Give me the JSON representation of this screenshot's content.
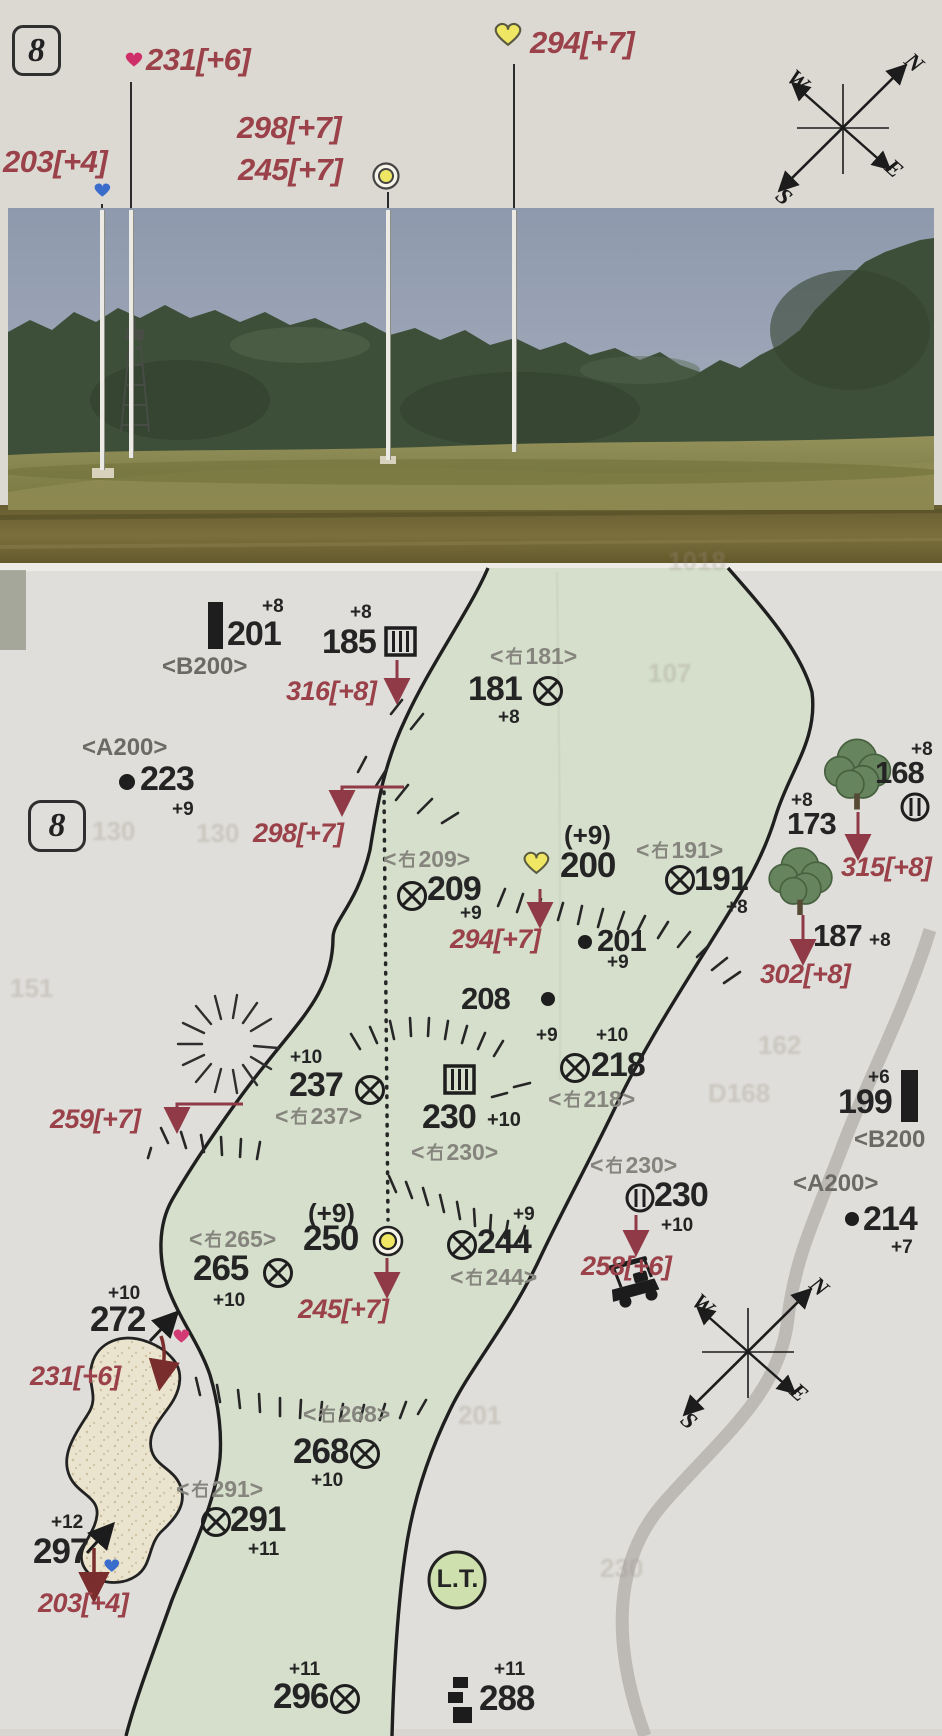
{
  "hole": "8",
  "compass": {
    "n": "N",
    "w": "W",
    "e": "E",
    "s": "S"
  },
  "sym": {
    "lt": "<"
  },
  "top": {
    "f231": "231[+6]",
    "f294": "294[+7]",
    "f298": "298[+7]",
    "f245": "245[+7]",
    "f203": "203[+4]"
  },
  "map": {
    "m201": {
      "v": "201",
      "sup": "+8",
      "ref": "<B200>"
    },
    "m185": {
      "v": "185",
      "sup": "+8"
    },
    "a316": "316[+8]",
    "m181": {
      "v": "181",
      "sup": "+8",
      "ref": "181>"
    },
    "m223": {
      "v": "223",
      "sup": "+9",
      "ref": "<A200>"
    },
    "a298": "298[+7]",
    "m209": {
      "v": "209",
      "sup": "+9",
      "ref": "209>"
    },
    "m200": {
      "v": "200",
      "pre": "(+9)"
    },
    "a294": "294[+7]",
    "m191": {
      "v": "191",
      "sup": "+8",
      "ref": "191>"
    },
    "m201b": {
      "v": "201",
      "sup": "+9"
    },
    "m208": {
      "v": "208",
      "sup": "+9"
    },
    "m218": {
      "v": "218",
      "sup": "+10",
      "ref": "218>"
    },
    "m237": {
      "v": "237",
      "sup": "+10",
      "ref": "237>"
    },
    "m230": {
      "v": "230",
      "sup": "+10",
      "ref": "230>"
    },
    "a259": "259[+7]",
    "m250": {
      "v": "250",
      "pre": "(+9)"
    },
    "a245": "245[+7]",
    "m265": {
      "v": "265",
      "sup": "+10",
      "ref": "265>"
    },
    "m244": {
      "v": "244",
      "sup": "+9",
      "ref": "244>"
    },
    "m230r": {
      "v": "230",
      "sup": "+10",
      "ref": "230>"
    },
    "a258": "258[+6]",
    "m199": {
      "v": "199",
      "sup": "+6",
      "ref": "<B200"
    },
    "m214": {
      "v": "214",
      "sup": "+7",
      "ref": "<A200>"
    },
    "m168": {
      "v": "168",
      "sup": "+8"
    },
    "m173": {
      "v": "173",
      "sup": "+8"
    },
    "a315": "315[+8]",
    "m187": {
      "v": "187",
      "sup": "+8"
    },
    "a302": "302[+8]",
    "m272": {
      "v": "272",
      "sup": "+10"
    },
    "a231": "231[+6]",
    "m297": {
      "v": "297",
      "sup": "+12"
    },
    "a203": "203[+4]",
    "m268": {
      "v": "268",
      "sup": "+10",
      "ref": "268>"
    },
    "m291": {
      "v": "291",
      "sup": "+11",
      "ref": "291>"
    },
    "lt": "L.T.",
    "m296": {
      "v": "296",
      "sup": "+11"
    },
    "m288": {
      "v": "288",
      "sup": "+11"
    }
  },
  "ghosts": [
    "1018",
    "107",
    "151",
    "130",
    "130",
    "162",
    "D168",
    "201",
    "230"
  ],
  "colors": {
    "fairway": "#d5dfcc",
    "annotation_red": "#9a4149",
    "sand": "#eae3cd",
    "page": "#dfdeda",
    "yellow_marker": "#efe763",
    "pink_marker": "#cf2f68",
    "blue_marker": "#3a6ccc"
  }
}
